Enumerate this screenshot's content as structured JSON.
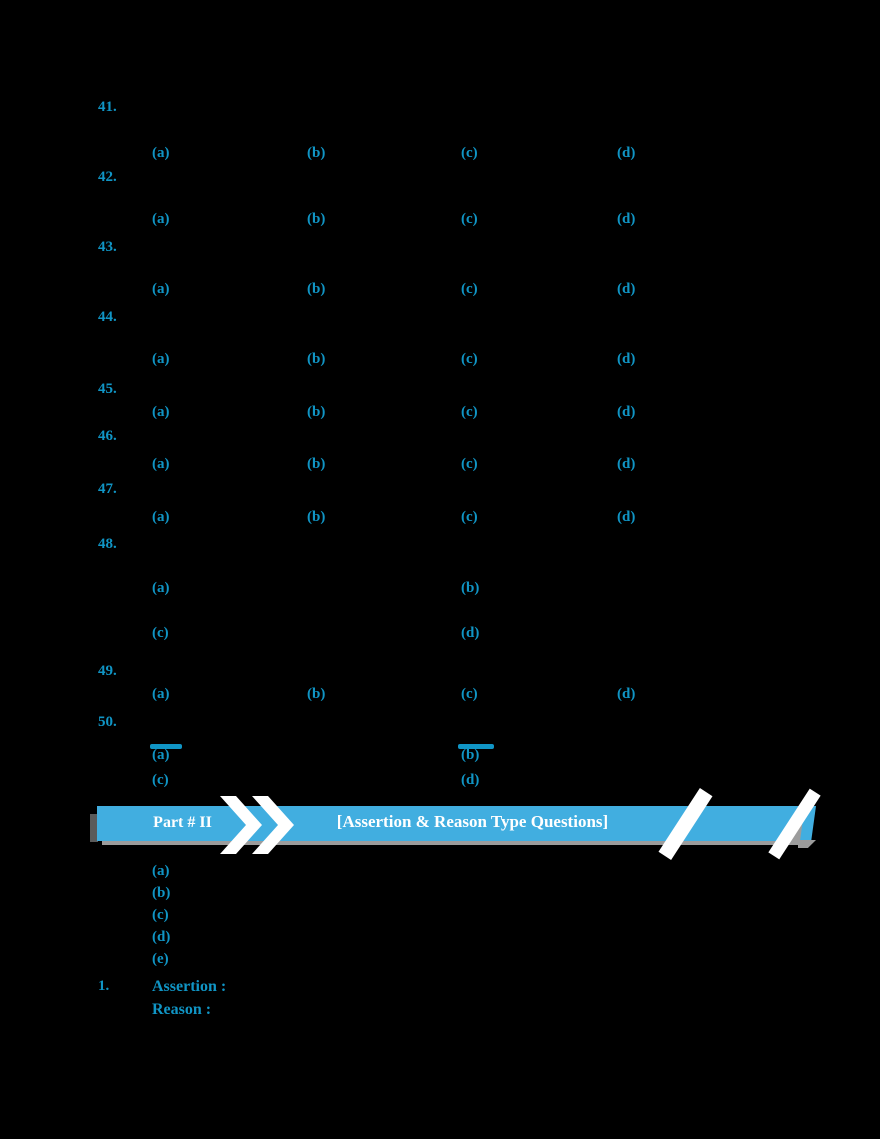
{
  "colors": {
    "background": "#000000",
    "accent_cyan": "#1095C5",
    "banner_blue": "#41AEE0",
    "banner_text": "#FFFFFF",
    "shadow_gray": "#9C9C9C",
    "notch_gray": "#5A5A5A"
  },
  "banner": {
    "part_label": "Part # II",
    "title": "[Assertion & Reason Type Questions]",
    "chevrons_icon": "double-chevron-right"
  },
  "part1": {
    "questions": [
      {
        "number": "41.",
        "number_top": 100,
        "rows": [
          {
            "top": 146,
            "labels": [
              "(a)",
              "(b)",
              "(c)",
              "(d)"
            ],
            "xs": [
              152,
              307,
              461,
              617
            ]
          }
        ]
      },
      {
        "number": "42.",
        "number_top": 170,
        "rows": [
          {
            "top": 212,
            "labels": [
              "(a)",
              "(b)",
              "(c)",
              "(d)"
            ],
            "xs": [
              152,
              307,
              461,
              617
            ]
          }
        ]
      },
      {
        "number": "43.",
        "number_top": 240,
        "rows": [
          {
            "top": 282,
            "labels": [
              "(a)",
              "(b)",
              "(c)",
              "(d)"
            ],
            "xs": [
              152,
              307,
              461,
              617
            ]
          }
        ]
      },
      {
        "number": "44.",
        "number_top": 310,
        "rows": [
          {
            "top": 352,
            "labels": [
              "(a)",
              "(b)",
              "(c)",
              "(d)"
            ],
            "xs": [
              152,
              307,
              461,
              617
            ]
          }
        ]
      },
      {
        "number": "45.",
        "number_top": 382,
        "rows": [
          {
            "top": 405,
            "labels": [
              "(a)",
              "(b)",
              "(c)",
              "(d)"
            ],
            "xs": [
              152,
              307,
              461,
              617
            ]
          }
        ]
      },
      {
        "number": "46.",
        "number_top": 429,
        "rows": [
          {
            "top": 457,
            "labels": [
              "(a)",
              "(b)",
              "(c)",
              "(d)"
            ],
            "xs": [
              152,
              307,
              461,
              617
            ]
          }
        ]
      },
      {
        "number": "47.",
        "number_top": 482,
        "rows": [
          {
            "top": 510,
            "labels": [
              "(a)",
              "(b)",
              "(c)",
              "(d)"
            ],
            "xs": [
              152,
              307,
              461,
              617
            ]
          }
        ]
      },
      {
        "number": "48.",
        "number_top": 537,
        "rows": [
          {
            "top": 581,
            "labels": [
              "(a)",
              "(b)"
            ],
            "xs": [
              152,
              461
            ]
          },
          {
            "top": 626,
            "labels": [
              "(c)",
              "(d)"
            ],
            "xs": [
              152,
              461
            ]
          }
        ]
      },
      {
        "number": "49.",
        "number_top": 664,
        "rows": [
          {
            "top": 687,
            "labels": [
              "(a)",
              "(b)",
              "(c)",
              "(d)"
            ],
            "xs": [
              152,
              307,
              461,
              617
            ]
          }
        ]
      },
      {
        "number": "50.",
        "number_top": 715,
        "rows": [
          {
            "top": 748,
            "labels": [
              "(a)",
              "(b)"
            ],
            "xs": [
              152,
              461
            ]
          },
          {
            "top": 773,
            "labels": [
              "(c)",
              "(d)"
            ],
            "xs": [
              152,
              461
            ]
          }
        ]
      }
    ],
    "detail_bars": [
      {
        "x": 150,
        "top": 744,
        "w": 32,
        "h": 5
      },
      {
        "x": 458,
        "top": 744,
        "w": 36,
        "h": 5
      }
    ]
  },
  "part2": {
    "answer_choices": {
      "labels": [
        "(a)",
        "(b)",
        "(c)",
        "(d)",
        "(e)"
      ],
      "x": 152,
      "top": 864,
      "gap": 22
    },
    "first_question": {
      "number": "1.",
      "number_top": 979,
      "x": 152,
      "lines": [
        {
          "text": "Assertion :",
          "top": 979,
          "name": "assertion-label"
        },
        {
          "text": "Reason :",
          "top": 1002,
          "name": "reason-label"
        }
      ]
    }
  }
}
